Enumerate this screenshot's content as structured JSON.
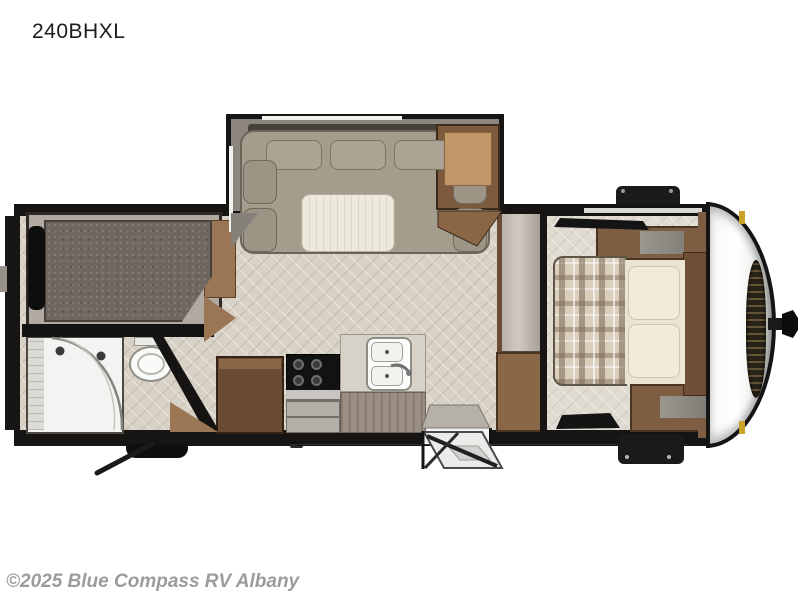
{
  "header": {
    "model_label": "240BHXL"
  },
  "watermark": {
    "text": "©2025 Blue Compass RV Albany"
  },
  "colors": {
    "wall": "#171513",
    "floor": "#d8d1c5",
    "slide_interior": "#8d8680",
    "sofa": "#a49c8c",
    "sofa_shadow": "#45423c",
    "table": "#eee9dd",
    "wood_dark": "#6a4a33",
    "wood_mid": "#7d5e43",
    "wood_light": "#c1986a",
    "bunk_mattress": "#6f6761",
    "bunk_frame": "#b1aaa2",
    "bed_plaid_base": "#d9cfbc",
    "linen": "#ece4d2",
    "bath_white": "#f3f3f1",
    "metal": "#b2aea8",
    "accent_gold": "#c9a22a",
    "cap_white": "#ffffff",
    "chassis_black": "#111111"
  }
}
